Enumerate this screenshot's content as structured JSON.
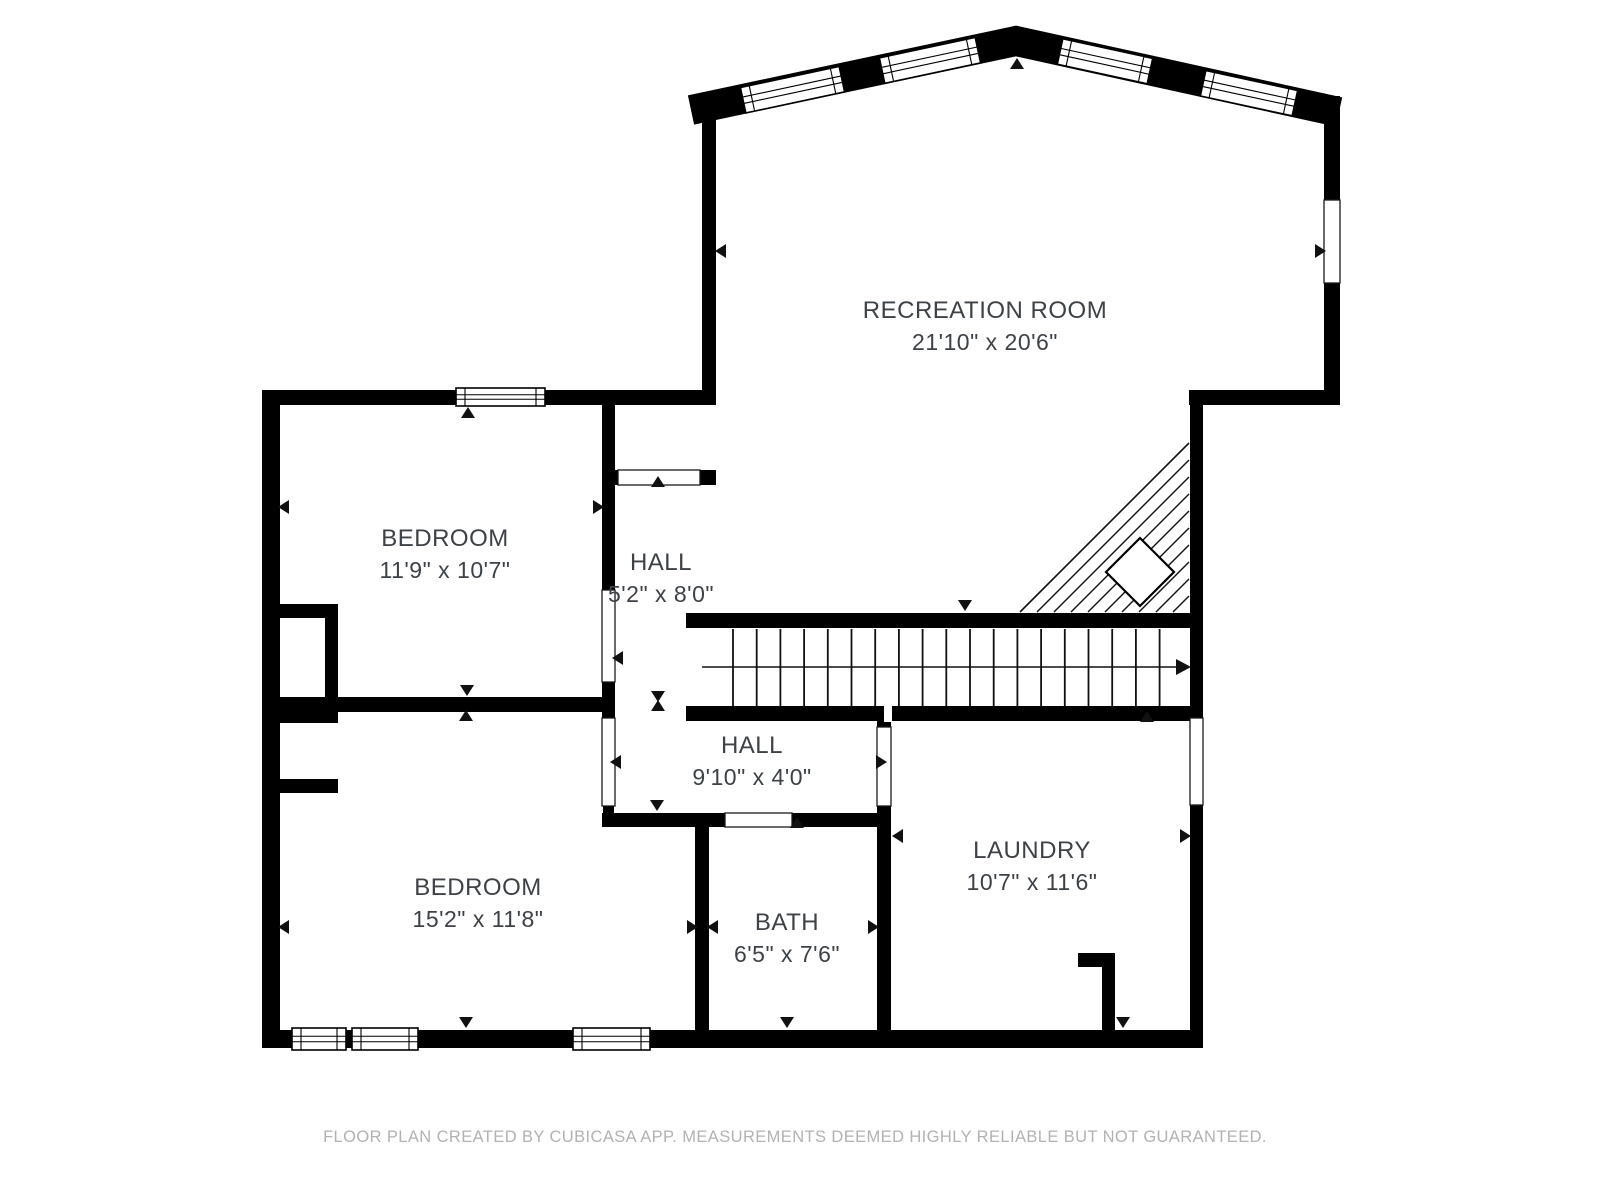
{
  "colors": {
    "wall": "#000000",
    "background": "#ffffff",
    "label": "#3d4247",
    "footer": "#b2b2b2"
  },
  "rooms": [
    {
      "id": "recreation-room",
      "name": "RECREATION ROOM",
      "dimensions": "21'10\" x 20'6\""
    },
    {
      "id": "bedroom-1",
      "name": "BEDROOM",
      "dimensions": "11'9\" x 10'7\""
    },
    {
      "id": "hall-1",
      "name": "HALL",
      "dimensions": "5'2\" x 8'0\""
    },
    {
      "id": "bedroom-2",
      "name": "BEDROOM",
      "dimensions": "15'2\" x 11'8\""
    },
    {
      "id": "hall-2",
      "name": "HALL",
      "dimensions": "9'10\" x 4'0\""
    },
    {
      "id": "bath",
      "name": "BATH",
      "dimensions": "6'5\" x 7'6\""
    },
    {
      "id": "laundry",
      "name": "LAUNDRY",
      "dimensions": "10'7\" x 11'6\""
    }
  ],
  "footer": {
    "text": "FLOOR PLAN CREATED BY CUBICASA APP. MEASUREMENTS DEEMED HIGHLY RELIABLE BUT NOT GUARANTEED."
  }
}
